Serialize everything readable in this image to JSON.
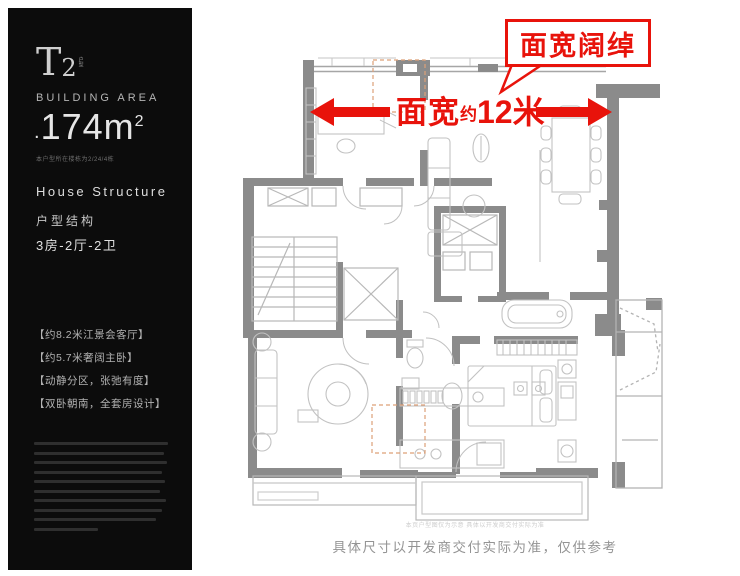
{
  "sidebar": {
    "bg_color": "#0c0c0c",
    "model_letter": "T",
    "model_number": "2",
    "model_tag": "户型",
    "building_area_label": "BUILDING AREA",
    "area_dot": ".",
    "area_value": "174m",
    "area_sup": "2",
    "area_note": "本户型所在楼栋为2/24/4栋",
    "structure_en": "House Structure",
    "structure_cn": "户型结构",
    "layout": "3房-2厅-2卫",
    "features": [
      "【约8.2米江景会客厅】",
      "【约5.7米奢阔主卧】",
      "【动静分区，张弛有度】",
      "【双卧朝南，全套房设计】"
    ],
    "disclaimer_bar_widths": [
      134,
      130,
      133,
      128,
      131,
      126,
      132,
      128,
      122,
      64
    ]
  },
  "plan": {
    "callout_text": "面宽阔绰",
    "width_text_1": "面宽",
    "width_text_2": "约",
    "width_text_3": "12米",
    "accent_red": "#e8130b",
    "wall_gray": "#8b8b8b"
  },
  "footer": {
    "small_print": "本页户型图仅为示意 具体以开发商交付实际为准",
    "caption": "具体尺寸以开发商交付实际为准，仅供参考"
  }
}
